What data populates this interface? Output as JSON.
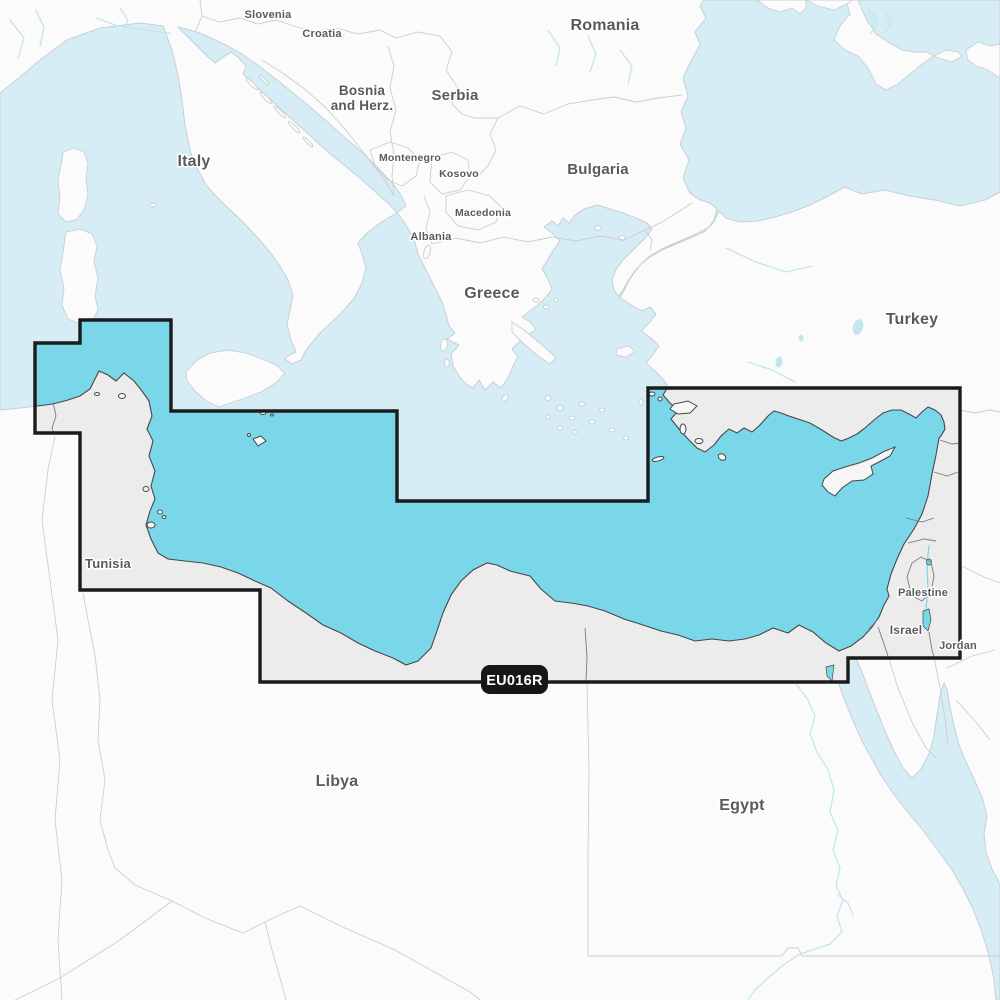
{
  "map": {
    "description": "Nautical chart coverage map of the Mediterranean Sea Southeast",
    "badge": {
      "code": "EU016R"
    },
    "colors": {
      "coverage_sea": "#7ad7e9",
      "coverage_border": "#1b1b1b",
      "sea": "#d6edf6",
      "land_outside": "#fbfbfb",
      "land_inside": "#ececec",
      "island_inside": "#f6f6f6",
      "coast_outside": "#c7d0d6",
      "coast_inside": "#474747",
      "border_light": "#cdcdcd",
      "border_dark": "#7b7b7b",
      "river": "#c3e5f1",
      "label_text": "#5a5a5a",
      "badge_bg": "#161616",
      "badge_text": "#ffffff"
    },
    "labels": {
      "slovenia": {
        "text": "Slovenia"
      },
      "croatia": {
        "text": "Croatia"
      },
      "bosnia_line1": {
        "text": "Bosnia"
      },
      "bosnia_line2": {
        "text": "and Herz."
      },
      "serbia": {
        "text": "Serbia"
      },
      "romania": {
        "text": "Romania"
      },
      "bulgaria": {
        "text": "Bulgaria"
      },
      "montenegro": {
        "text": "Montenegro"
      },
      "kosovo": {
        "text": "Kosovo"
      },
      "macedonia": {
        "text": "Macedonia"
      },
      "albania": {
        "text": "Albania"
      },
      "italy": {
        "text": "Italy"
      },
      "greece": {
        "text": "Greece"
      },
      "turkey": {
        "text": "Turkey"
      },
      "tunisia": {
        "text": "Tunisia"
      },
      "libya": {
        "text": "Libya"
      },
      "egypt": {
        "text": "Egypt"
      },
      "palestine": {
        "text": "Palestine"
      },
      "israel": {
        "text": "Israel"
      },
      "jordan": {
        "text": "Jordan"
      }
    }
  }
}
